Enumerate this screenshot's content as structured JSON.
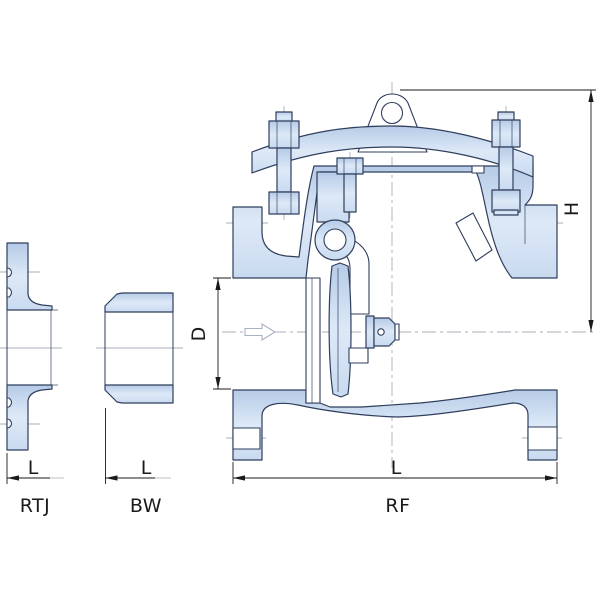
{
  "drawing": {
    "title": "swing check valve end-connection drawing",
    "views": {
      "rtj": {
        "label": "RTJ",
        "dim_length": "L"
      },
      "bw": {
        "label": "BW",
        "dim_length": "L"
      },
      "rf": {
        "label": "RF",
        "dim_length": "L",
        "dim_bore": "D",
        "dim_height": "H"
      }
    },
    "icons": {
      "flow_arrow": "flow-direction-arrow"
    },
    "colors": {
      "body_fill": "#ccddf0",
      "outline": "#2f3e5c",
      "dimension": "#1a1a1a",
      "centerline": "#a8aeb8"
    }
  }
}
